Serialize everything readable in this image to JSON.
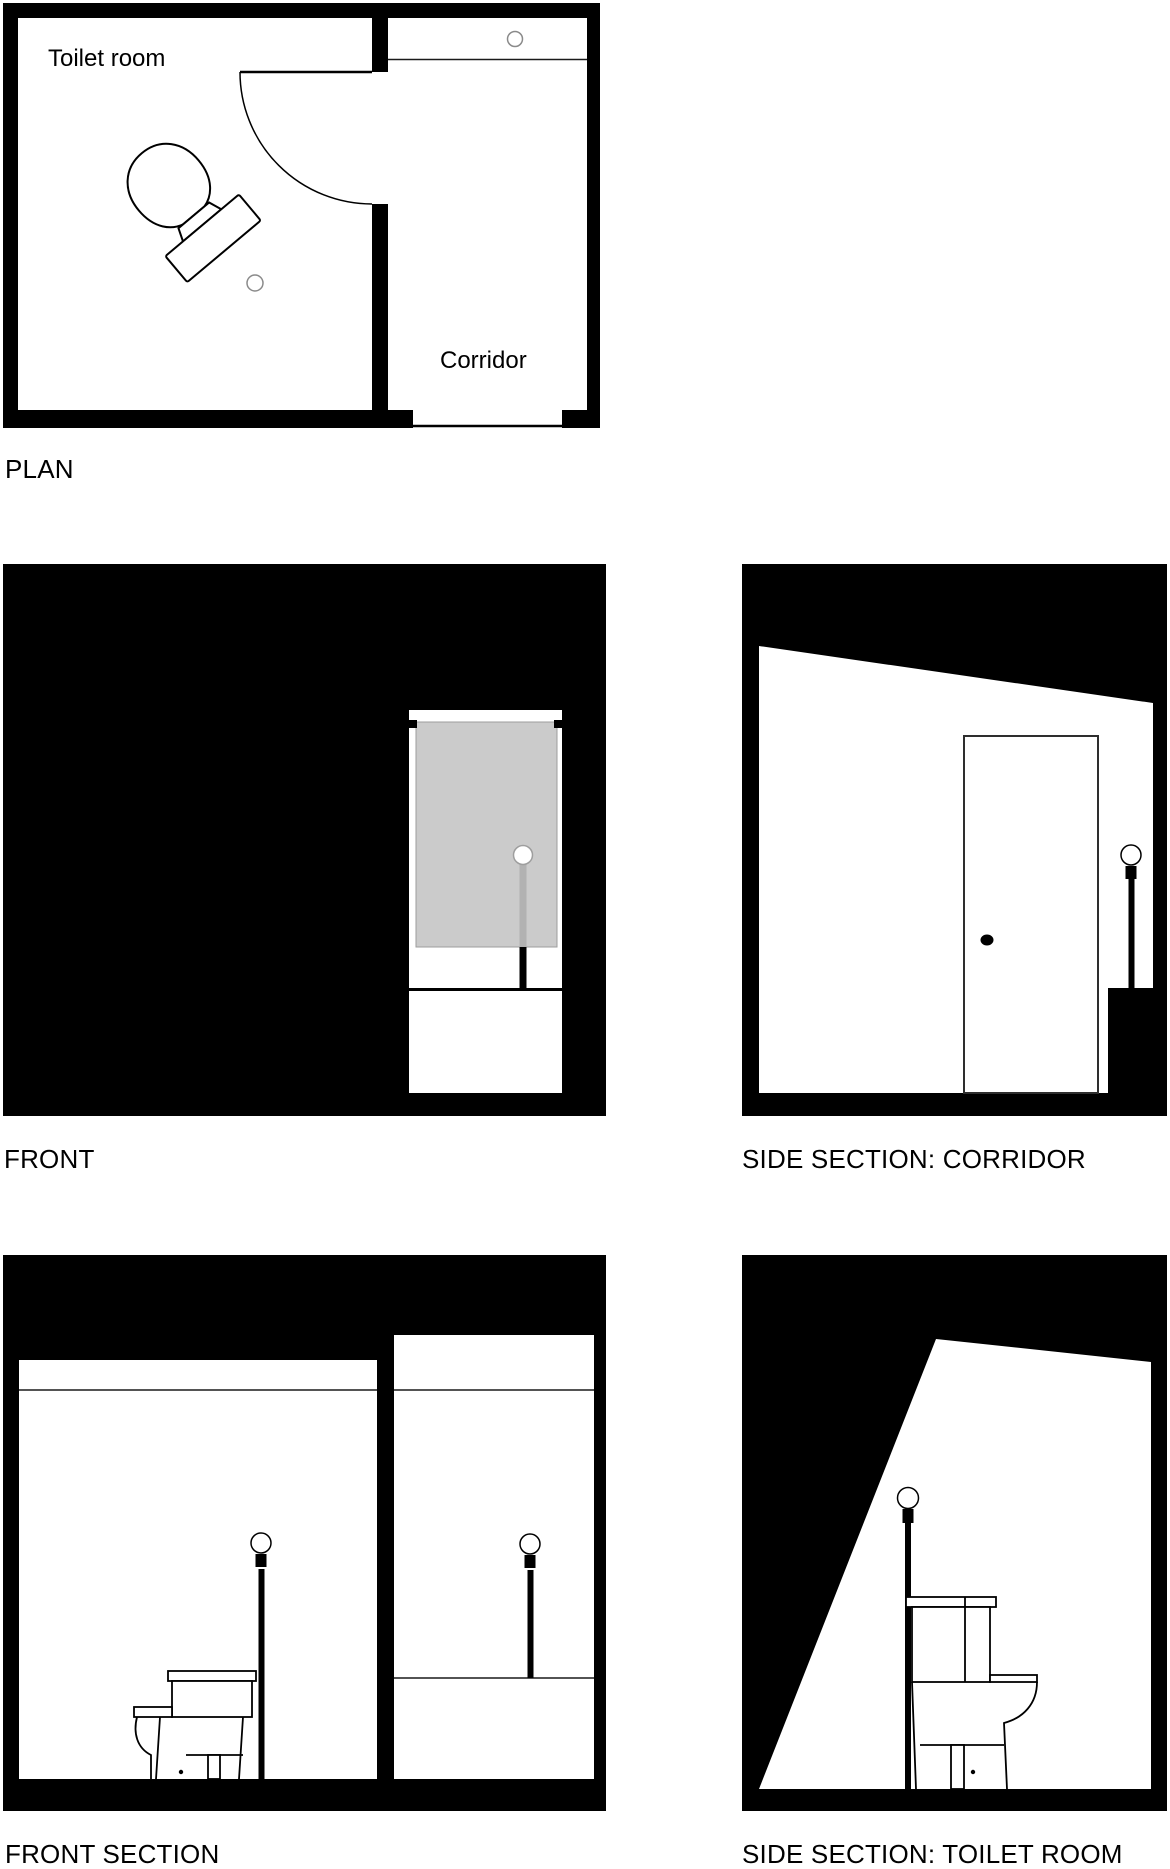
{
  "document": {
    "type": "architectural drawing set",
    "subject": "toilet room and corridor"
  },
  "colors": {
    "ink": "#000000",
    "paper": "#ffffff",
    "glass_panel_gray": "#cbcbcb",
    "pole_gray": "#b2b2b2",
    "soft_outline_gray": "#9e9e9e",
    "thin_line": "#1a1a1a",
    "door_frame": "#2e2e2e"
  },
  "plan": {
    "title": "PLAN",
    "room_label": "Toilet room",
    "corridor_label": "Corridor"
  },
  "views": {
    "front": {
      "title": "FRONT"
    },
    "side_corridor": {
      "title": "SIDE SECTION: CORRIDOR"
    },
    "front_section": {
      "title": "FRONT SECTION"
    },
    "side_toilet": {
      "title": "SIDE SECTION: TOILET ROOM"
    }
  }
}
